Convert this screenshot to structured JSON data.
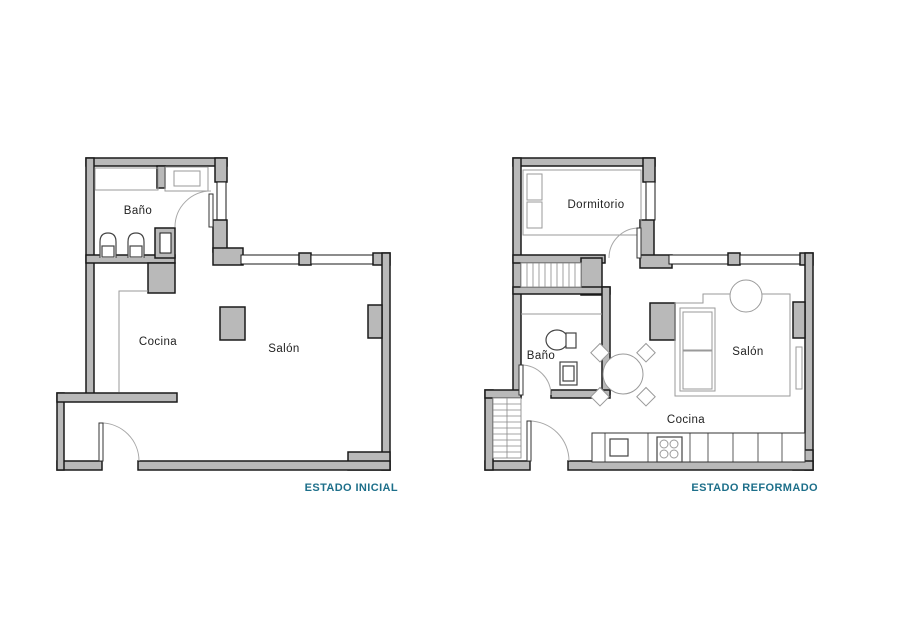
{
  "colors": {
    "wall_fill": "#b9b9b9",
    "wall_outline": "#1a1a1a",
    "furniture_line": "#9a9a9a",
    "fixture_line": "#444444",
    "caption_teal": "#1d6f8a",
    "label_text": "#222222",
    "page_bg": "#ffffff"
  },
  "plans": {
    "initial": {
      "caption": "ESTADO INICIAL",
      "rooms": [
        {
          "label": "Baño"
        },
        {
          "label": "Cocina"
        },
        {
          "label": "Salón"
        }
      ]
    },
    "reformed": {
      "caption": "ESTADO REFORMADO",
      "rooms": [
        {
          "label": "Dormitorio"
        },
        {
          "label": "Baño"
        },
        {
          "label": "Salón"
        },
        {
          "label": "Cocina"
        }
      ]
    }
  }
}
